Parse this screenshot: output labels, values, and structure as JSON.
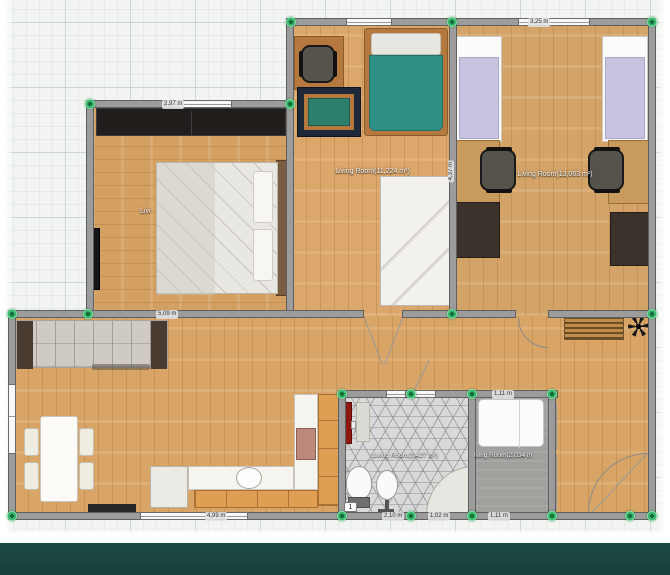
{
  "app_context": "floor-plan-editor-canvas",
  "rooms": {
    "left": {
      "label": "Livi"
    },
    "middle": {
      "label": "Living Room(11,224 m²)"
    },
    "right": {
      "label": "Living Room(13,063 m²)"
    },
    "bathroom": {
      "label": "Living Room(3,427 m²)"
    },
    "small_bedroom": {
      "label": "iving Room(2,034 m"
    }
  },
  "dimensions": {
    "left_room_top": "2,97 m",
    "right_room_top": "3,25 m",
    "living_room_wall": "5,09 m",
    "middle_right_wall_vertical": "4,37 m",
    "bottom_left": "4,99 m",
    "bathroom_bottom": "2,10 m",
    "bottom_mid_small": "1,02 m",
    "small_bedroom_bottom": "1,11 m",
    "small_bedroom_top": "1,11 m"
  },
  "badges": {
    "door_number": "1"
  },
  "colors": {
    "handle_green": "#34b567",
    "wall_gray": "#9c9c9c",
    "wood_floor": "#d8a566",
    "teal_band": "#1d4a45",
    "bed_blanket_teal": "#2f9186",
    "bed_blanket_lavender": "#c7c4e0",
    "appliance_red": "#8e1710"
  }
}
